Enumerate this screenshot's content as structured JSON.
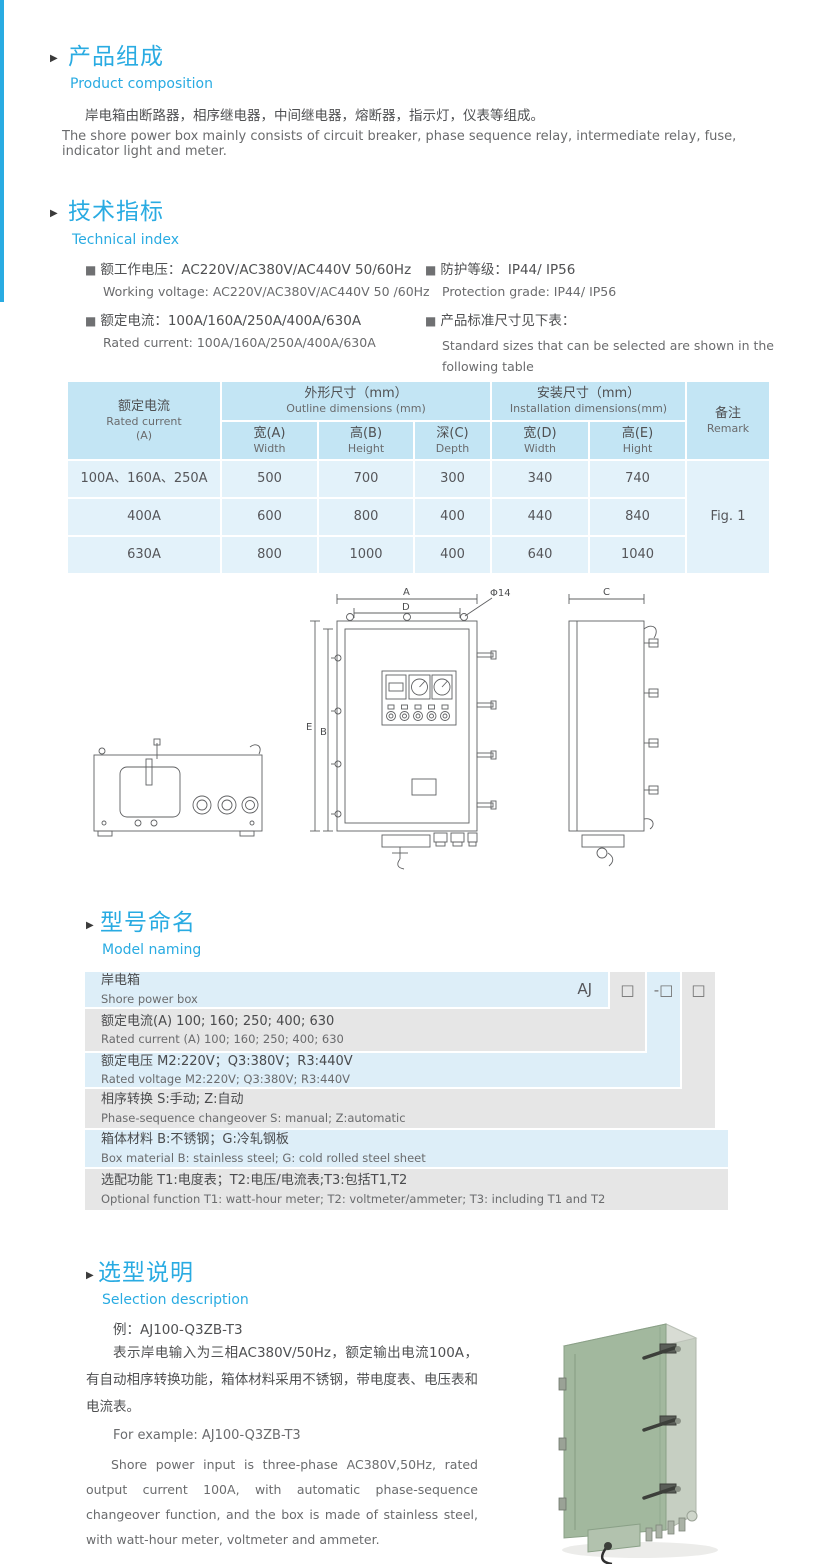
{
  "colors": {
    "accent": "#29abe2",
    "table_header": "#c3e5f4",
    "table_row": "#e3f2fa",
    "naming_blue": "#ddeef8",
    "naming_gray": "#e6e6e6",
    "text": "#58595b",
    "box_green": "#a2b89e"
  },
  "icons": {
    "section_marker": "▶",
    "bullet": "■",
    "code_box": "□",
    "dash": "-"
  },
  "composition": {
    "title_zh": "产品组成",
    "title_en": "Product  composition",
    "body_zh": "岸电箱由断路器，相序继电器，中间继电器，熔断器，指示灯，仪表等组成。",
    "body_en": "The shore power box mainly consists of circuit breaker, phase sequence relay, intermediate relay, fuse, indicator light and meter."
  },
  "technical": {
    "title_zh": "技术指标",
    "title_en": "Technical index",
    "specs_left": [
      {
        "zh": "额工作电压：AC220V/AC380V/AC440V  50/60Hz",
        "en": "Working voltage: AC220V/AC380V/AC440V 50 /60Hz"
      },
      {
        "zh": "额定电流：100A/160A/250A/400A/630A",
        "en": "Rated current: 100A/160A/250A/400A/630A"
      }
    ],
    "specs_right": [
      {
        "zh": "防护等级：IP44/ IP56",
        "en": "Protection grade: IP44/ IP56"
      },
      {
        "zh": "产品标准尺寸见下表：",
        "en": "Standard sizes that can be selected are shown in the following table"
      }
    ]
  },
  "table": {
    "rated": {
      "zh": "额定电流",
      "en": "Rated current",
      "unit": "(A)"
    },
    "outline_group": {
      "zh": "外形尺寸（mm）",
      "en": "Outline dimensions (mm)"
    },
    "install_group": {
      "zh": "安装尺寸（mm）",
      "en": "Installation dimensions(mm)"
    },
    "remark": {
      "zh": "备注",
      "en": "Remark"
    },
    "sub_headers": [
      {
        "zh": "宽(A)",
        "en": "Width"
      },
      {
        "zh": "高(B)",
        "en": "Height"
      },
      {
        "zh": "深(C)",
        "en": "Depth"
      },
      {
        "zh": "宽(D)",
        "en": "Width"
      },
      {
        "zh": "高(E)",
        "en": "Hight"
      }
    ],
    "rows": [
      {
        "current": "100A、160A、250A",
        "values": [
          "500",
          "700",
          "300",
          "340",
          "740"
        ]
      },
      {
        "current": "400A",
        "values": [
          "600",
          "800",
          "400",
          "440",
          "840"
        ]
      },
      {
        "current": "630A",
        "values": [
          "800",
          "1000",
          "400",
          "640",
          "1040"
        ]
      }
    ],
    "figure_ref": "Fig. 1"
  },
  "drawing": {
    "labels": {
      "width_a": "A",
      "inner_d": "D",
      "hole": "Φ14",
      "height_e": "E",
      "height_b": "B",
      "depth_c": "C"
    }
  },
  "naming": {
    "title_zh": "型号命名",
    "title_en": "Model naming",
    "prefix": "AJ",
    "rows": [
      {
        "zh": "岸电箱",
        "en": "Shore power box"
      },
      {
        "zh": "额定电流(A)  100; 160; 250; 400; 630",
        "en": "Rated current (A)  100; 160; 250; 400; 630"
      },
      {
        "zh": "额定电压   M2:220V；Q3:380V；R3:440V",
        "en": "Rated voltage   M2:220V;  Q3:380V;  R3:440V"
      },
      {
        "zh": "相序转换  S:手动; Z:自动",
        "en": "Phase-sequence changeover  S: manual;  Z:automatic"
      },
      {
        "zh": "箱体材料   B:不锈钢；G:冷轧钢板",
        "en": "Box material   B: stainless steel; G: cold rolled steel sheet"
      },
      {
        "zh": "选配功能   T1:电度表；T2:电压/电流表;T3:包括T1,T2",
        "en": "Optional function  T1: watt-hour meter; T2: voltmeter/ammeter; T3: including T1 and T2"
      }
    ]
  },
  "selection": {
    "title_zh": "选型说明",
    "title_en": "Selection description",
    "example_zh": "例：AJ100-Q3ZB-T3",
    "desc_zh": "表示岸电输入为三相AC380V/50Hz，额定输出电流100A，有自动相序转换功能，箱体材料采用不锈钢，带电度表、电压表和电流表。",
    "example_en": "For example: AJ100-Q3ZB-T3",
    "desc_en": "Shore power input is three-phase AC380V,50Hz, rated output current 100A, with automatic phase-sequence changeover function, and the box is made of stainless steel, with watt-hour meter, voltmeter and ammeter."
  }
}
